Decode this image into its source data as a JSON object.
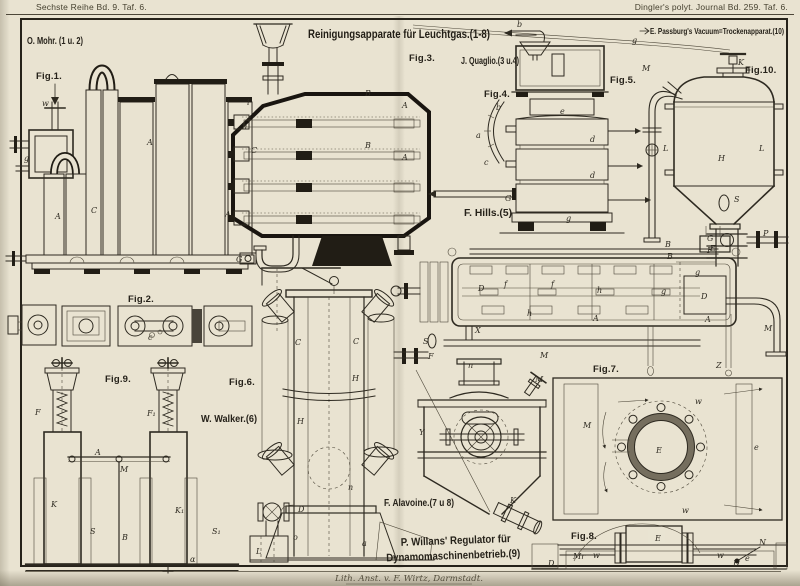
{
  "page": {
    "header_left": "Sechste Reihe Bd. 9. Taf. 6.",
    "header_right": "Dingler's polyt. Journal Bd. 259. Taf. 6.",
    "title_main": "Reinigungsapparate für Leuchtgas.(1-8)",
    "title_right": "E. Passburg's Vacuum=Trockenapparat.(10)",
    "footer_credit": "Lith. Anst. v. F. Wirtz, Darmstadt.",
    "colors": {
      "paper": "#e9e3d1",
      "ink": "#2e2a21",
      "ink_heavy": "#191510",
      "shade": "#756e5e"
    }
  },
  "attributions": {
    "mohr": "O. Mohr. (1 u. 2)",
    "quaglio": "J. Quaglio.(3 u.4)",
    "hills": "F. Hills.(5)",
    "walker": "W. Walker.(6)",
    "alavoine": "F. Alavoine.(7 u 8)",
    "willans_line1": "P. Willans' Regulator für",
    "willans_line2": "Dynamomaschinenbetrieb.(9)"
  },
  "figures": {
    "fig1": {
      "caption": "Fig.1.",
      "parts": [
        "w",
        "g",
        "A",
        "C",
        "A",
        "A",
        "G"
      ]
    },
    "fig2": {
      "caption": "Fig.2.",
      "parts": [
        "c"
      ]
    },
    "fig3": {
      "caption": "Fig.3.",
      "parts": [
        "i",
        "n",
        "C",
        "B",
        "A",
        "B",
        "A"
      ]
    },
    "fig4": {
      "caption": "Fig.4.",
      "parts": [
        "b",
        "a",
        "c"
      ]
    },
    "fig5": {
      "caption": "Fig.5.",
      "parts": [
        "b",
        "e",
        "d",
        "d",
        "G",
        "g"
      ]
    },
    "fig6": {
      "caption": "Fig.6.",
      "parts": [
        "C",
        "C",
        "H",
        "H",
        "D",
        "o",
        "L",
        "a",
        "n"
      ]
    },
    "fig7": {
      "caption": "Fig.7.",
      "parts": [
        "M",
        "E",
        "e",
        "w",
        "w",
        "Z"
      ]
    },
    "fig8": {
      "caption": "Fig.8.",
      "parts": [
        "Mr",
        "w",
        "E",
        "D",
        "D",
        "N",
        "e",
        "w"
      ]
    },
    "fig9": {
      "caption": "Fig.9.",
      "parts": [
        "F",
        "F₁",
        "A",
        "M",
        "K",
        "S",
        "B",
        "K₁",
        "S₁",
        "α"
      ]
    },
    "fig10": {
      "caption": "Fig.10.",
      "parts": [
        "M",
        "K",
        "L",
        "L",
        "H",
        "S",
        "G",
        "F",
        "P",
        "B",
        "g"
      ]
    },
    "hills": {
      "parts": [
        "S",
        "B",
        "D",
        "f",
        "f",
        "h",
        "h",
        "A",
        "D",
        "g",
        "g",
        "E",
        "X",
        "F",
        "M",
        "M",
        "A"
      ]
    },
    "alavoine": {
      "parts": [
        "Y",
        "K",
        "n",
        "M"
      ]
    }
  }
}
